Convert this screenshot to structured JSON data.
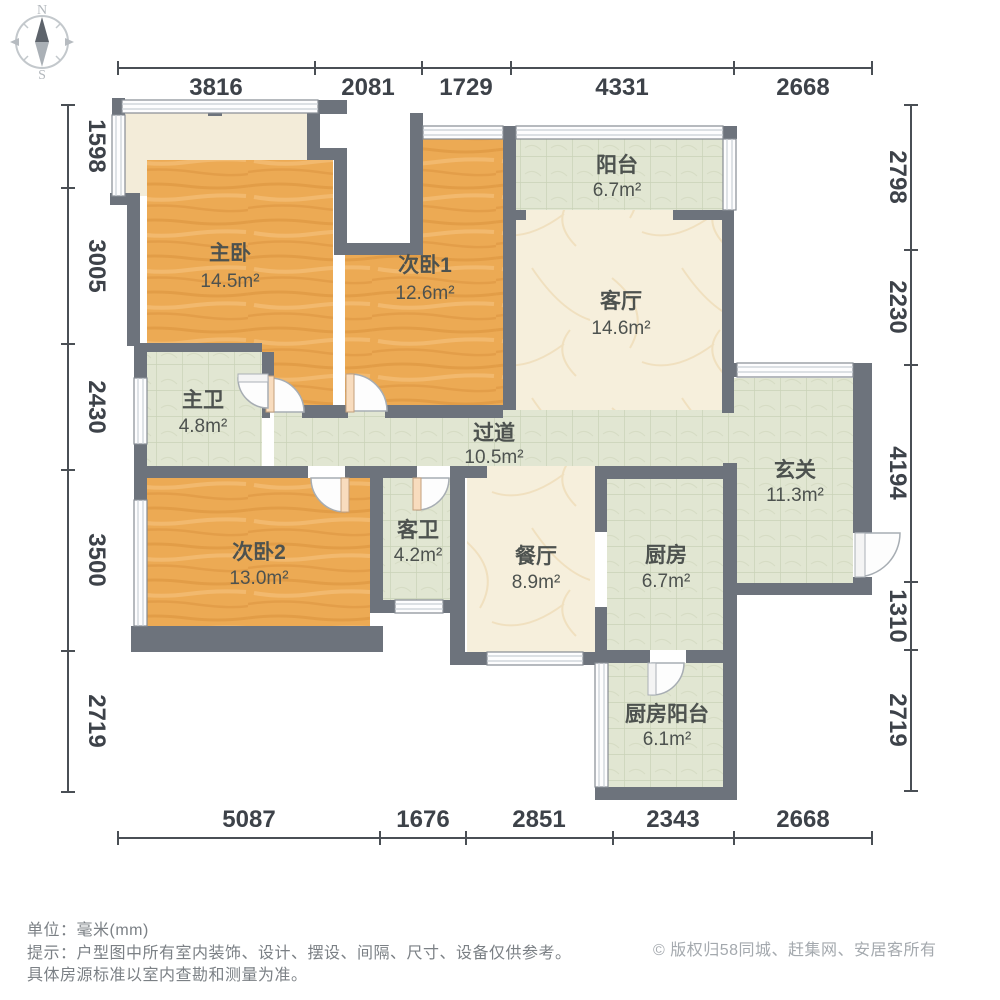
{
  "diagram_type": "apartment-floor-plan",
  "compass": {
    "north": "N",
    "south": "S"
  },
  "rooms": [
    {
      "id": "master-bedroom",
      "name": "主卧",
      "area": "14.5m²",
      "floor": "wood"
    },
    {
      "id": "bedroom-1",
      "name": "次卧1",
      "area": "12.6m²",
      "floor": "wood"
    },
    {
      "id": "balcony",
      "name": "阳台",
      "area": "6.7m²",
      "floor": "tile"
    },
    {
      "id": "living-room",
      "name": "客厅",
      "area": "14.6m²",
      "floor": "marble"
    },
    {
      "id": "master-bath",
      "name": "主卫",
      "area": "4.8m²",
      "floor": "tile"
    },
    {
      "id": "hallway",
      "name": "过道",
      "area": "10.5m²",
      "floor": "tile"
    },
    {
      "id": "foyer",
      "name": "玄关",
      "area": "11.3m²",
      "floor": "tile"
    },
    {
      "id": "bedroom-2",
      "name": "次卧2",
      "area": "13.0m²",
      "floor": "wood"
    },
    {
      "id": "guest-bath",
      "name": "客卫",
      "area": "4.2m²",
      "floor": "tile"
    },
    {
      "id": "dining-room",
      "name": "餐厅",
      "area": "8.9m²",
      "floor": "marble"
    },
    {
      "id": "kitchen",
      "name": "厨房",
      "area": "6.7m²",
      "floor": "tile"
    },
    {
      "id": "kitchen-balcony",
      "name": "厨房阳台",
      "area": "6.1m²",
      "floor": "tile"
    }
  ],
  "dimensions": {
    "unit": "mm",
    "top": [
      "3816",
      "2081",
      "1729",
      "4331",
      "2668"
    ],
    "left": [
      "1598",
      "3005",
      "2430",
      "3500",
      "2719"
    ],
    "right": [
      "2798",
      "2230",
      "4194",
      "1310",
      "2719"
    ],
    "bottom": [
      "5087",
      "1676",
      "2851",
      "2343",
      "2668"
    ]
  },
  "footer": {
    "unit_line": "单位：毫米(mm)",
    "tip_line": "提示：户型图中所有室内装饰、设计、摆设、间隔、尺寸、设备仅供参考。",
    "tip_line2": "具体房源标准以室内查勘和测量为准。",
    "copyright": "© 版权归58同城、赶集网、安居客所有"
  },
  "colors": {
    "wall": "#6d737c",
    "wood_floor": "#eca851",
    "tile_floor": "#e1e6d2",
    "marble_floor": "#f6efdc",
    "bay_area": "#f3ecd9",
    "dimension_text": "#3d4249",
    "room_text": "#4d524f",
    "footer_text": "#7b8085",
    "copyright_text": "#a4a9ae"
  }
}
